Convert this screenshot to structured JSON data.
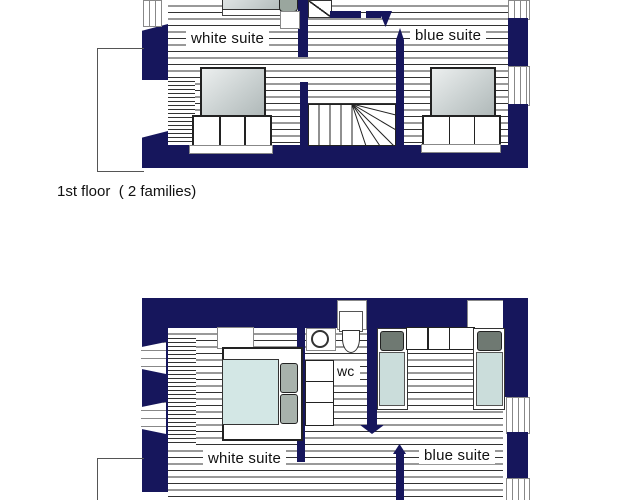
{
  "figure": {
    "caption": "1st floor  ( 2 families)"
  },
  "first_floor": {
    "white_suite_label": "white suite",
    "blue_suite_label": "blue suite"
  },
  "lower_floor": {
    "white_suite_label": "white suite",
    "blue_suite_label": "blue suite",
    "wc_label": "wc"
  },
  "colors": {
    "wall_navy": "#16165c",
    "hatch_line": "#333333",
    "bed_gradient_light": "#ecefef",
    "bed_gradient_dark": "#aeb7b7",
    "mattress_cyan": "#d3e7e5",
    "pillow_gray": "#a8b2ac",
    "pillow_dark": "#6f7972",
    "single_mattress": "#cbdddb",
    "frame_line": "#888888",
    "outline_gray": "#555555",
    "text_color": "#111111"
  }
}
